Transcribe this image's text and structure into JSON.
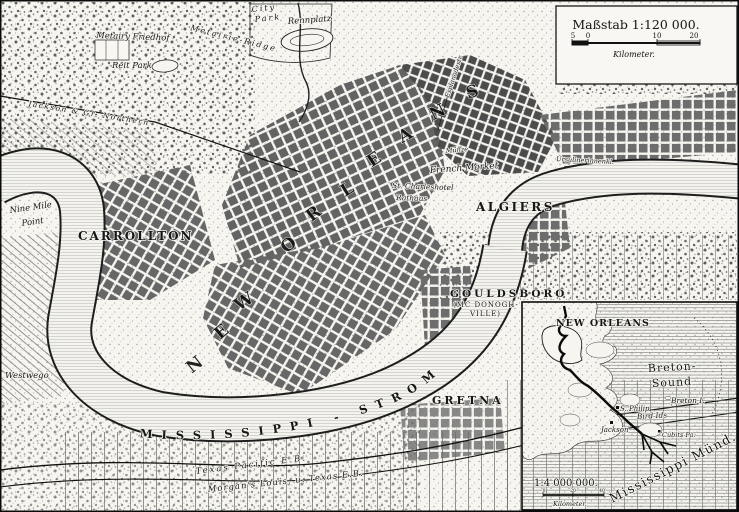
{
  "map": {
    "scale_box": {
      "title": "Maßstab 1:120 000.",
      "ticks": [
        "5",
        "0",
        "10",
        "20"
      ],
      "unit": "Kilometer."
    },
    "river_label": "MISSISSIPPI - STROM",
    "big_letters": [
      {
        "ch": "N",
        "x": 198,
        "y": 369,
        "r": -38
      },
      {
        "ch": "E",
        "x": 225,
        "y": 336,
        "r": -40
      },
      {
        "ch": "W",
        "x": 247,
        "y": 306,
        "r": -34
      },
      {
        "ch": "O",
        "x": 292,
        "y": 249,
        "r": -40
      },
      {
        "ch": "R",
        "x": 317,
        "y": 218,
        "r": -38
      },
      {
        "ch": "L",
        "x": 350,
        "y": 194,
        "r": -32
      },
      {
        "ch": "E",
        "x": 377,
        "y": 164,
        "r": -34
      },
      {
        "ch": "A",
        "x": 408,
        "y": 140,
        "r": -30
      },
      {
        "ch": "N",
        "x": 440,
        "y": 117,
        "r": -27
      },
      {
        "ch": "S",
        "x": 474,
        "y": 97,
        "r": -18
      }
    ],
    "labels": [
      {
        "id": "city-park-line1",
        "t": "City",
        "x": 252,
        "y": 12,
        "f": 8,
        "r": -6,
        "ls": 2,
        "c": "it"
      },
      {
        "id": "city-park-line2",
        "t": "Park",
        "x": 255,
        "y": 22,
        "f": 8,
        "r": -6,
        "ls": 2,
        "c": "it"
      },
      {
        "id": "rennplatz",
        "t": "Rennplatz",
        "x": 288,
        "y": 24,
        "f": 8.5,
        "r": -4,
        "c": "it"
      },
      {
        "id": "metairie-friedhof",
        "t": "Metairy Friedhof",
        "x": 96,
        "y": 38,
        "f": 8.5,
        "r": 2,
        "c": "it"
      },
      {
        "id": "metairie-ridge",
        "t": "Metairie-Ridge",
        "x": 190,
        "y": 30,
        "f": 8,
        "r": 14,
        "ls": 2,
        "c": "it"
      },
      {
        "id": "reit-park",
        "t": "Reit Park",
        "x": 112,
        "y": 68,
        "f": 8.5,
        "c": "it"
      },
      {
        "id": "jackson-railroad",
        "t": "Jackson & Gr. Northern",
        "x": 28,
        "y": 106,
        "f": 7.5,
        "r": 9,
        "ls": 1.5,
        "c": "it"
      },
      {
        "id": "nine-mile-point-1",
        "t": "Nine Mile",
        "x": 10,
        "y": 213,
        "f": 8.5,
        "r": -8,
        "c": "it"
      },
      {
        "id": "nine-mile-point-2",
        "t": "Point",
        "x": 22,
        "y": 226,
        "f": 8.5,
        "r": -8,
        "c": "it"
      },
      {
        "id": "carrollton",
        "t": "CARROLLTON",
        "x": 78,
        "y": 240,
        "f": 12,
        "ls": 2,
        "c": "b"
      },
      {
        "id": "westwego",
        "t": "Westwego",
        "x": 5,
        "y": 378,
        "f": 8.5,
        "c": "it"
      },
      {
        "id": "muenze",
        "t": "Münze",
        "x": 446,
        "y": 153,
        "f": 6.5,
        "r": -5,
        "c": "it"
      },
      {
        "id": "french-market",
        "t": "French Market",
        "x": 430,
        "y": 173,
        "f": 9,
        "r": -4,
        "c": "it"
      },
      {
        "id": "st-charleshotel",
        "t": "St. Charleshotel",
        "x": 392,
        "y": 188,
        "f": 7.5,
        "r": 2,
        "c": "it"
      },
      {
        "id": "rathaus",
        "t": "Rathaus",
        "x": 396,
        "y": 200,
        "f": 7.5,
        "r": 2,
        "c": "it"
      },
      {
        "id": "algiers",
        "t": "ALGIERS",
        "x": 476,
        "y": 211,
        "f": 12,
        "ls": 2.5,
        "c": "b"
      },
      {
        "id": "ursulinerinnen",
        "t": "Ursulinerinnenkl.",
        "x": 556,
        "y": 161,
        "f": 6.5,
        "r": 3,
        "c": "it"
      },
      {
        "id": "esplanadestrasse",
        "t": "Esplanadestr.",
        "x": 449,
        "y": 98,
        "f": 6.5,
        "r": -72,
        "c": "it"
      },
      {
        "id": "gouldsboro-1",
        "t": "GOULDSBORO",
        "x": 450,
        "y": 297,
        "f": 10.5,
        "ls": 3,
        "c": "b"
      },
      {
        "id": "gouldsboro-2",
        "t": "(MC DONOGH-",
        "x": 453,
        "y": 307,
        "f": 7,
        "ls": 1
      },
      {
        "id": "gouldsboro-3",
        "t": "VILLE)",
        "x": 470,
        "y": 316,
        "f": 7,
        "ls": 1
      },
      {
        "id": "gretna",
        "t": "GRETNA",
        "x": 432,
        "y": 404,
        "f": 11,
        "ls": 3,
        "c": "b"
      },
      {
        "id": "texas-pacific-railroad",
        "t": "Texas Pacific E.B.",
        "x": 196,
        "y": 474,
        "f": 8.5,
        "r": -7,
        "ls": 2,
        "c": "it"
      },
      {
        "id": "morgans-railroad",
        "t": "Morgan's Louis. u. Texas E.B.",
        "x": 208,
        "y": 492,
        "f": 8.5,
        "r": -6,
        "ls": 1,
        "c": "it"
      }
    ]
  },
  "inset": {
    "scale_bar": {
      "ratio": "1:4 000 000.",
      "ticks": [
        "0",
        "20",
        "40"
      ],
      "unit": "Kilometer."
    },
    "labels": [
      {
        "id": "inset-new-orleans",
        "t": "NEW ORLEANS",
        "x": 556,
        "y": 326,
        "f": 9.5,
        "ls": 1,
        "c": "b"
      },
      {
        "id": "breton-sound-1",
        "t": "Breton-",
        "x": 648,
        "y": 372,
        "f": 11,
        "r": -3,
        "ls": 1
      },
      {
        "id": "breton-sound-2",
        "t": "Sound",
        "x": 652,
        "y": 387,
        "f": 11,
        "r": -3,
        "ls": 1
      },
      {
        "id": "breton-island",
        "t": "Breton I.",
        "x": 671,
        "y": 403,
        "f": 7.5,
        "c": "it"
      },
      {
        "id": "fort-s-philip",
        "t": "S. Philip",
        "x": 620,
        "y": 411,
        "f": 7,
        "c": "it"
      },
      {
        "id": "bird-islands",
        "t": "Bird Ids",
        "x": 637,
        "y": 419,
        "f": 7.5,
        "r": -3,
        "c": "it"
      },
      {
        "id": "fort-jackson",
        "t": "Jackson",
        "x": 601,
        "y": 432,
        "f": 7,
        "c": "it"
      },
      {
        "id": "cubits-pass",
        "t": "Cubits Pa.",
        "x": 662,
        "y": 437,
        "f": 6.5,
        "c": "it"
      },
      {
        "id": "mississippi-muendungen",
        "t": "Mississippi Münd.",
        "x": 612,
        "y": 503,
        "f": 12.5,
        "r": -27,
        "ls": 1.5
      }
    ]
  }
}
